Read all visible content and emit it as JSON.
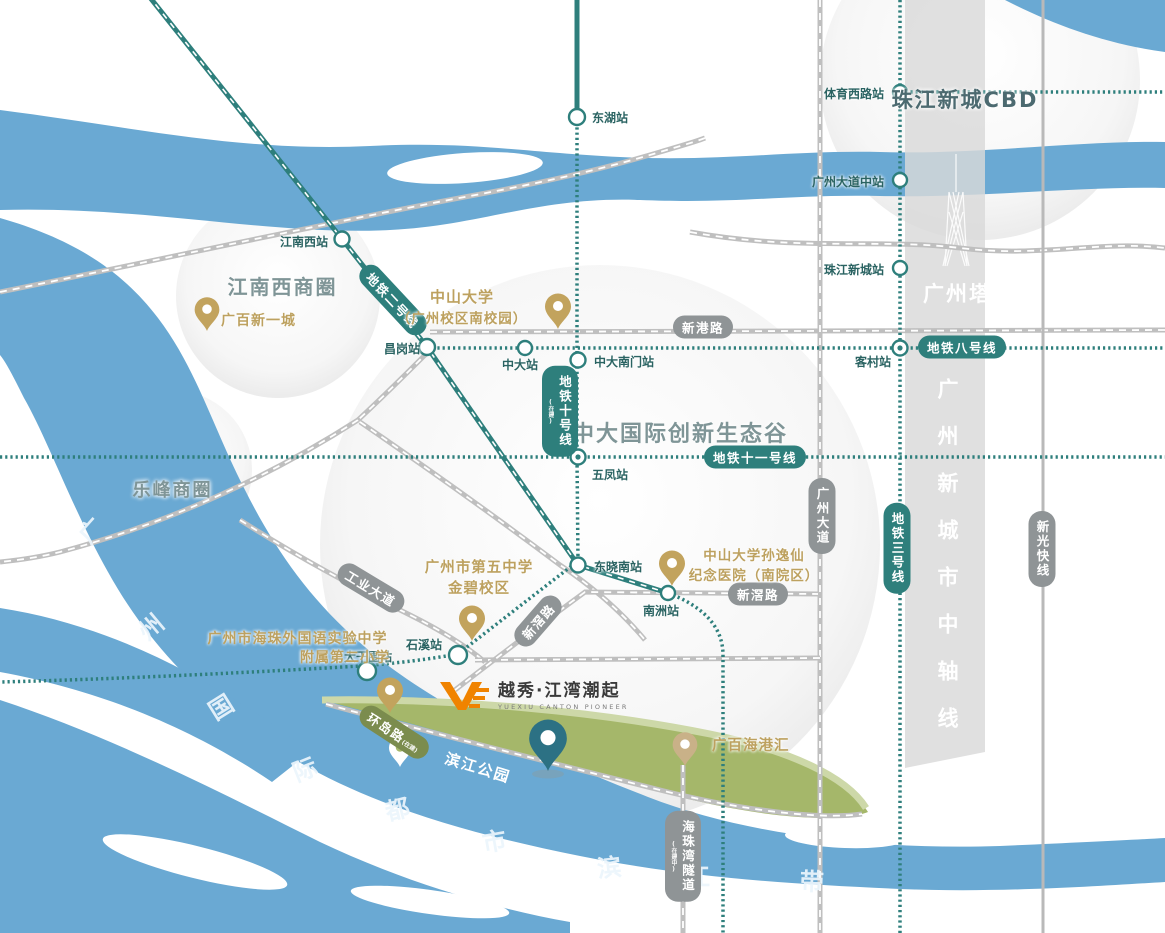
{
  "colors": {
    "metro_teal": "#2e7f7c",
    "river_blue": "#6aa9d3",
    "gold": "#bda15f",
    "park_green": "#a5b76a",
    "axis_gray": "#d9d9d9",
    "road_gray": "#bfbfbf",
    "logo_orange": "#f08300",
    "pill_gray": "#8f9496"
  },
  "logo": {
    "cn": "越秀·江湾潮起",
    "en": "YUEXIU CANTON PIONEER"
  },
  "areas": {
    "cbd": "珠江新城CBD",
    "canton_tower": "广州塔",
    "jiangnanxi": "江南西商圈",
    "lefeng": "乐峰商圈",
    "valley": "中大国际创新生态谷",
    "axis": "广州新城市中轴线",
    "river_belt": [
      "广",
      "州",
      "国",
      "际",
      "都",
      "市",
      "滨",
      "江",
      "带"
    ]
  },
  "metro": {
    "line2": "地铁二号线",
    "line3": "地铁三号线",
    "line8": "地铁八号线",
    "line10": "地铁十号线",
    "line10_note": "(在建)",
    "line11": "地铁十一号线"
  },
  "stations": {
    "donghu": "东湖站",
    "tiyuxilu": "体育西路站",
    "guangzhou_dadao_zhong": "广州大道中站",
    "zhujiang_xincheng": "珠江新城站",
    "jiangnanxi": "江南西站",
    "changgang": "昌岗站",
    "zhongda": "中大站",
    "zhongda_nanmen": "中大南门站",
    "kecun": "客村站",
    "wufeng": "五凤站",
    "dongxiaonan": "东晓南站",
    "nanzhou": "南洲站",
    "shixi": "石溪站",
    "daganwei": "大干围站"
  },
  "roads": {
    "xingang": "新港路",
    "xinjiao_d": "新滘路",
    "xinjiao_h": "新滘路",
    "gongye": "工业大道",
    "guangzhou_dadao": "广州大道",
    "xinguang": "新光快线",
    "huandao": "环岛路",
    "huandao_note": "(在建)",
    "haizhuwan": "海珠湾隧道",
    "haizhuwan_note": "(在建中)"
  },
  "pois": {
    "guangbai_xinyicheng": "广百新一城",
    "sysu_l1": "中山大学",
    "sysu_l2": "（广州校区南校园）",
    "hospital_l1": "中山大学孙逸仙",
    "hospital_l2": "纪念医院（南院区）",
    "school5_l1": "广州市第五中学",
    "school5_l2": "金碧校区",
    "foreign_l1": "广州市海珠外国语实验中学",
    "foreign_l2": "附属第二小学",
    "guangbai_haigang": "广百海港汇",
    "binjiang_park": "滨江公园"
  }
}
